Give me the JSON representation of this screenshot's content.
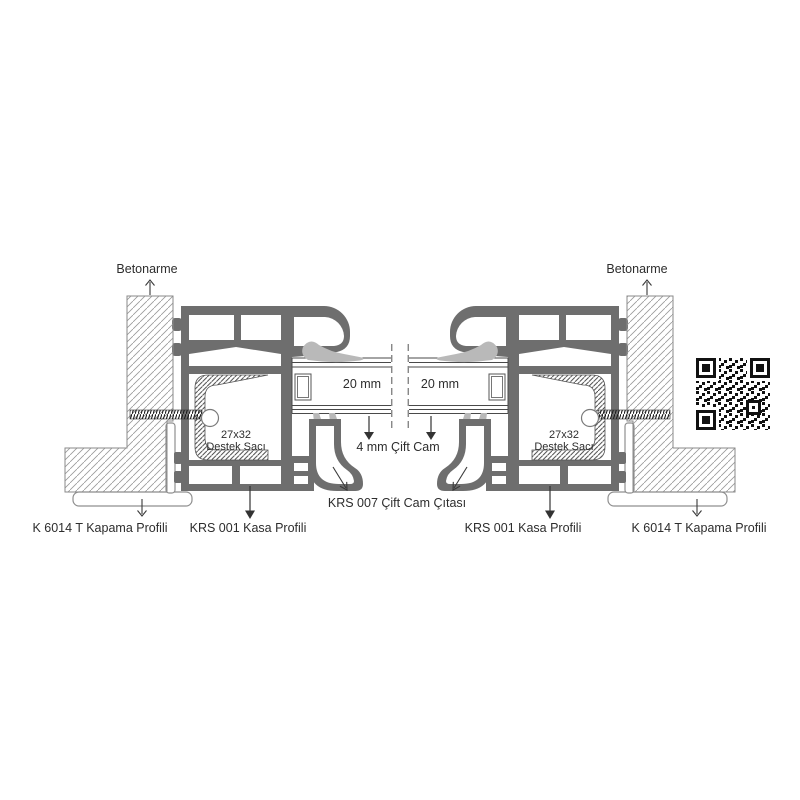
{
  "diagram": {
    "colors": {
      "profile": "#6e6e6e",
      "gasket": "#b9b9b9",
      "text": "#2d2d2d",
      "line": "#333333",
      "concrete_hatch": "#999999",
      "steel_hatch": "#3f3f3f"
    },
    "labels": {
      "betonarme_left": "Betonarme",
      "betonarme_right": "Betonarme",
      "glass_gap_left": "20 mm",
      "glass_gap_right": "20 mm",
      "glazing": "4 mm Çift Cam",
      "bead": "KRS 007 Çift Cam Çıtası",
      "support_left_line1": "27x32",
      "support_left_line2": "Destek Sacı",
      "support_right_line1": "27x32",
      "support_right_line2": "Destek Sacı",
      "closing_left": "K 6014 T Kapama Profili",
      "closing_right": "K 6014 T Kapama Profili",
      "frame_left": "KRS 001 Kasa Profili",
      "frame_right": "KRS 001 Kasa Profili"
    }
  }
}
